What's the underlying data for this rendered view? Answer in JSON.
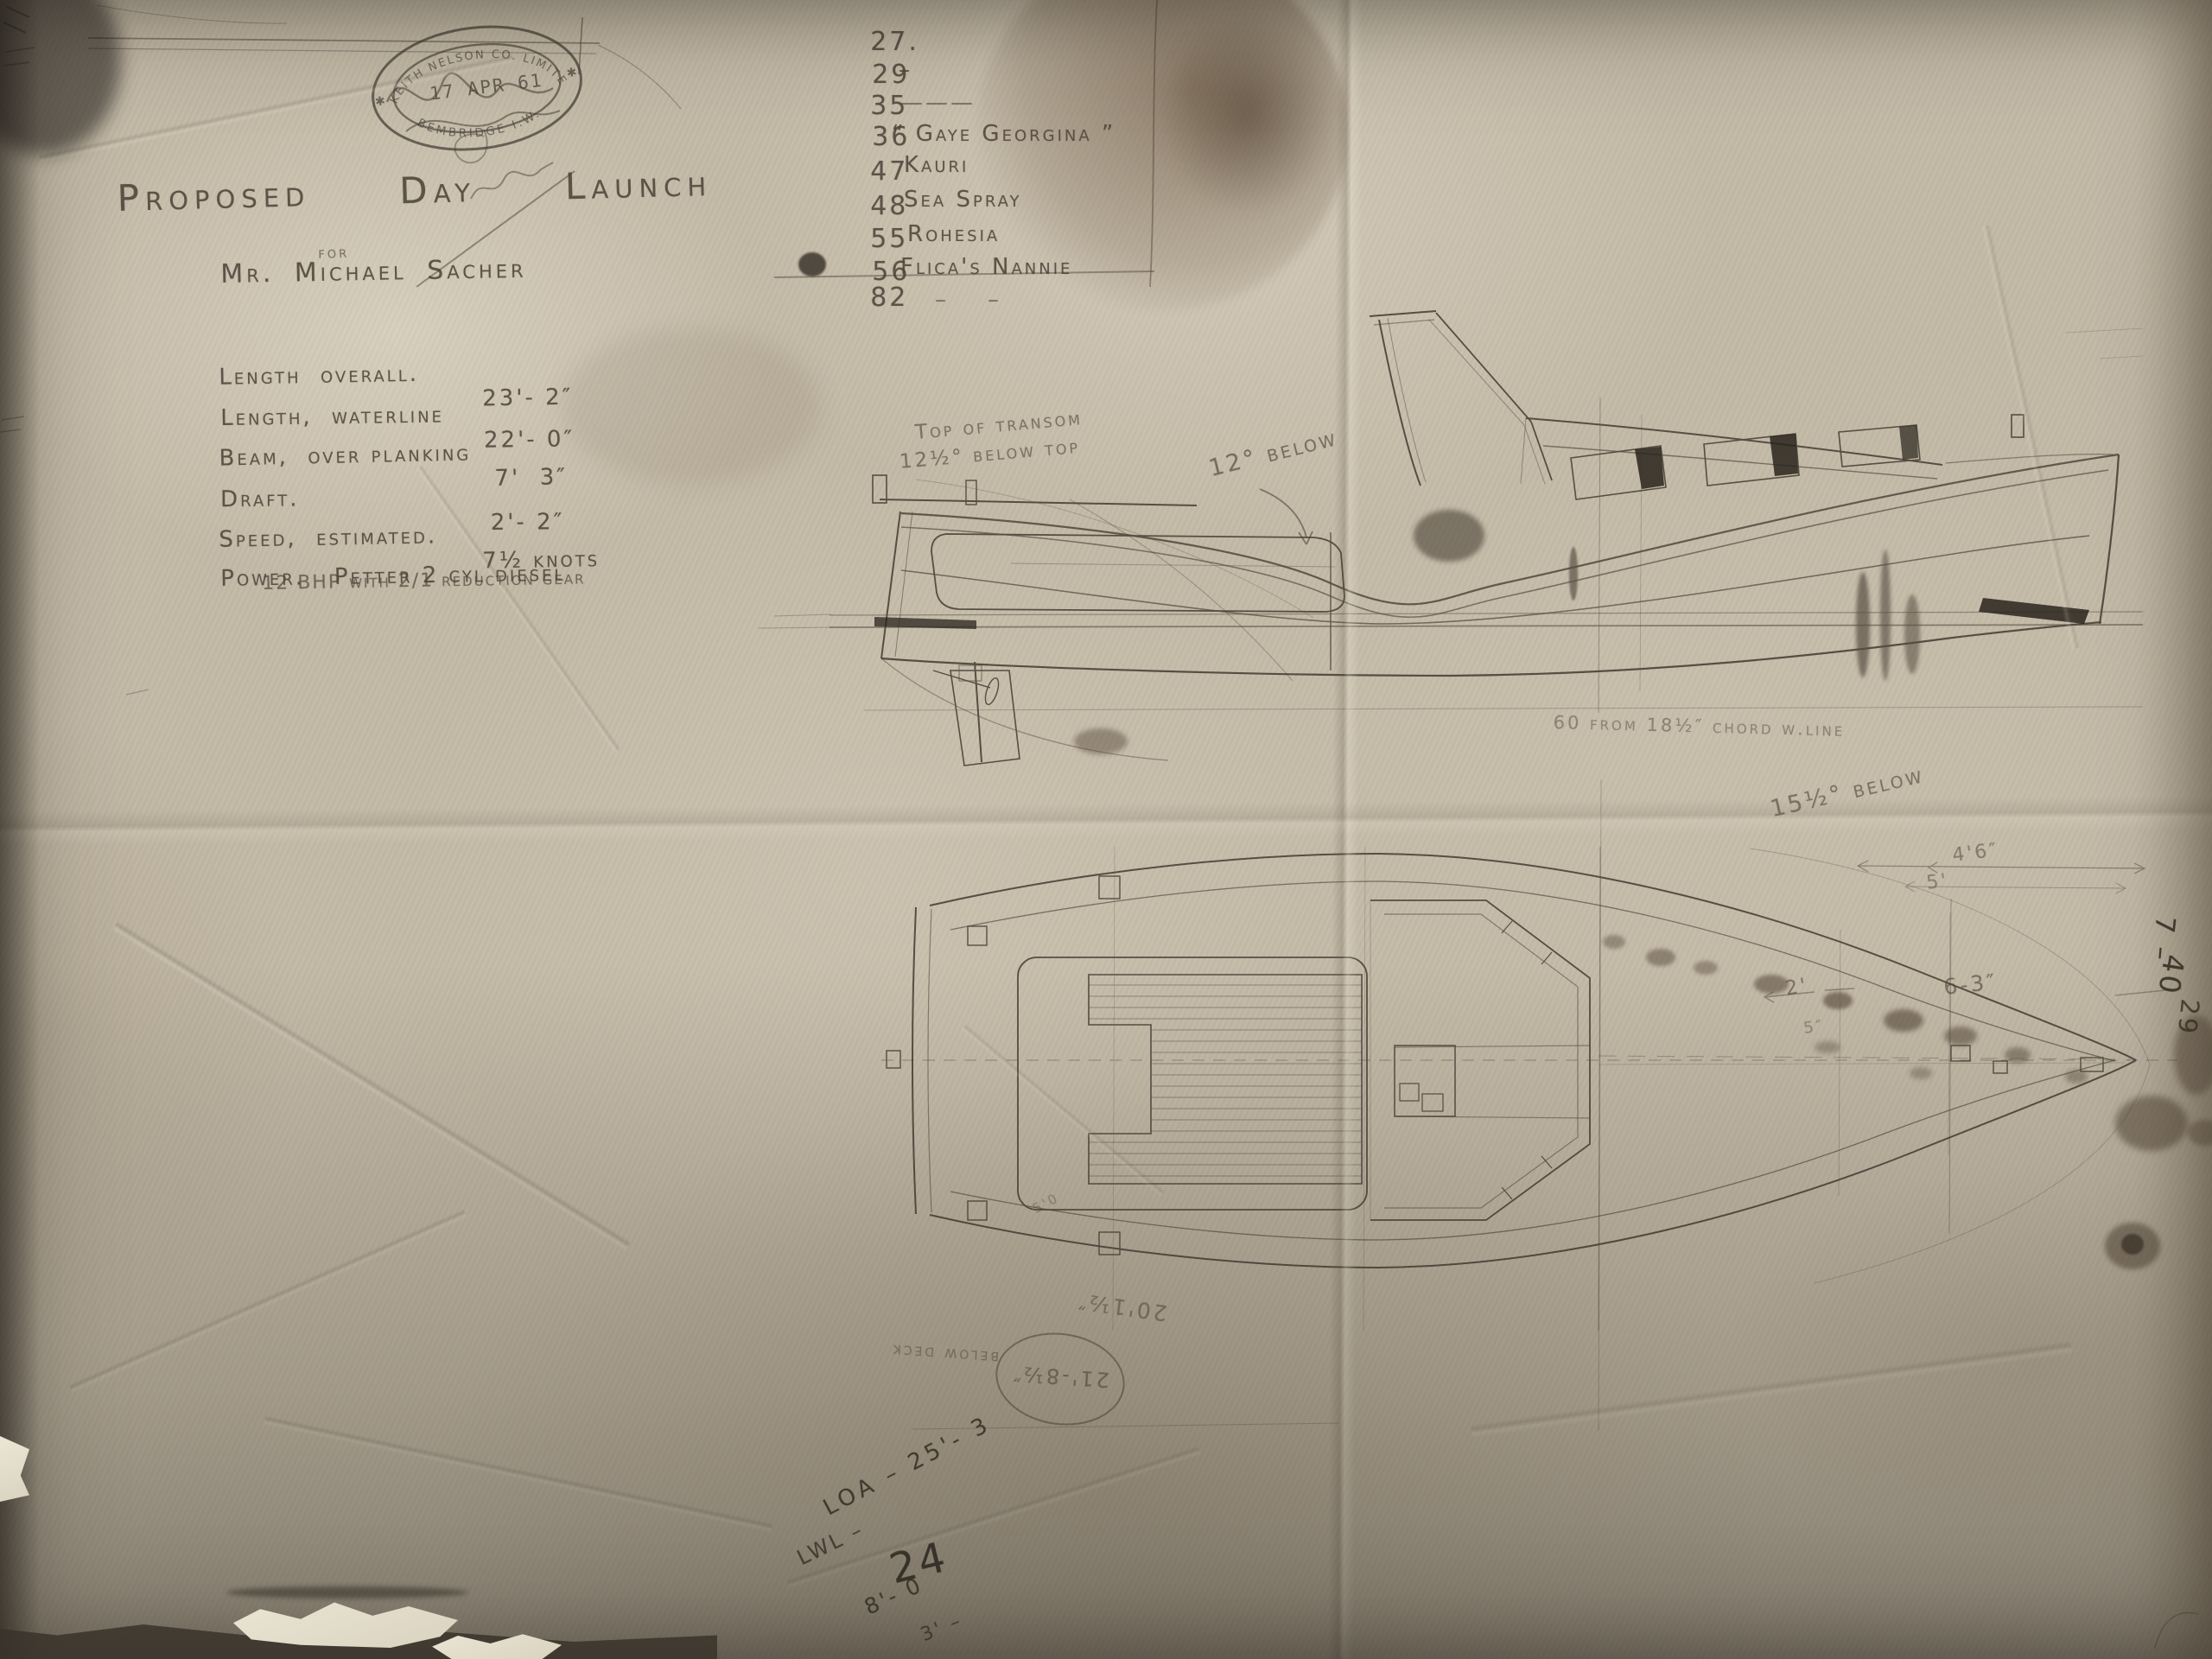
{
  "stamp": {
    "arc_top": "KEITH NELSON CO. LIMITED",
    "date": "17 APR 61",
    "arc_bottom": "BEMBRIDGE I.W.",
    "star": "✱"
  },
  "title": {
    "main": "Proposed   Day   Launch",
    "preposition": "for",
    "client": "Mr. Michael Sacher"
  },
  "specs": {
    "rows": [
      {
        "label": "Length  overall.",
        "value": "23'- 2″"
      },
      {
        "label": "Length,  waterline",
        "value": "22'- 0″"
      },
      {
        "label": "Beam,  over planking",
        "value": "7'  3″"
      },
      {
        "label": "Draft.",
        "value": "2'- 2″"
      },
      {
        "label": "Speed,  estimated.",
        "value": "7½ knots"
      },
      {
        "label": "Power.   Petter 2 cyl diesel",
        "value": ""
      }
    ],
    "power_note": "12 BHP with 2/1 reduction gear"
  },
  "registry": {
    "rows": [
      {
        "num": "27.",
        "name": "–"
      },
      {
        "num": "29",
        "name": "———"
      },
      {
        "num": "35",
        "name": "“ Gaye Georgina ”"
      },
      {
        "num": "36",
        "name": "Kauri"
      },
      {
        "num": "47",
        "name": "Sea Spray"
      },
      {
        "num": "48",
        "name": "Rohesia"
      },
      {
        "num": "55",
        "name": "Flica's Nannie"
      },
      {
        "num": "56",
        "name": "–    –"
      },
      {
        "num": "82",
        "name": ""
      }
    ]
  },
  "profile_notes": {
    "transom_line1": "Top of transom",
    "transom_line2": "12½° below top",
    "sheer_note": "12° below",
    "waterline_note": "60 from 18½″ chord w.line"
  },
  "plan_notes": {
    "angle_note": "15½° below",
    "dim_a": "4'6″",
    "dim_b": "5'",
    "dim_bow": "6-3″",
    "dim_c": "2'",
    "dim_d": "5″",
    "dim_e": "5'0"
  },
  "flipped_notes": {
    "length_note": "20'1½″",
    "circled_note": "21'-8½″",
    "circled_note2": "below deck"
  },
  "bottom_notes": {
    "loa": "LOA – 25'- 3",
    "lwl": "LWL –",
    "big": "24",
    "dim1": "8'- 0",
    "dim2": "3' –"
  },
  "edge_notes": {
    "n1": "7 –",
    "n2": "40",
    "n3": "29"
  }
}
